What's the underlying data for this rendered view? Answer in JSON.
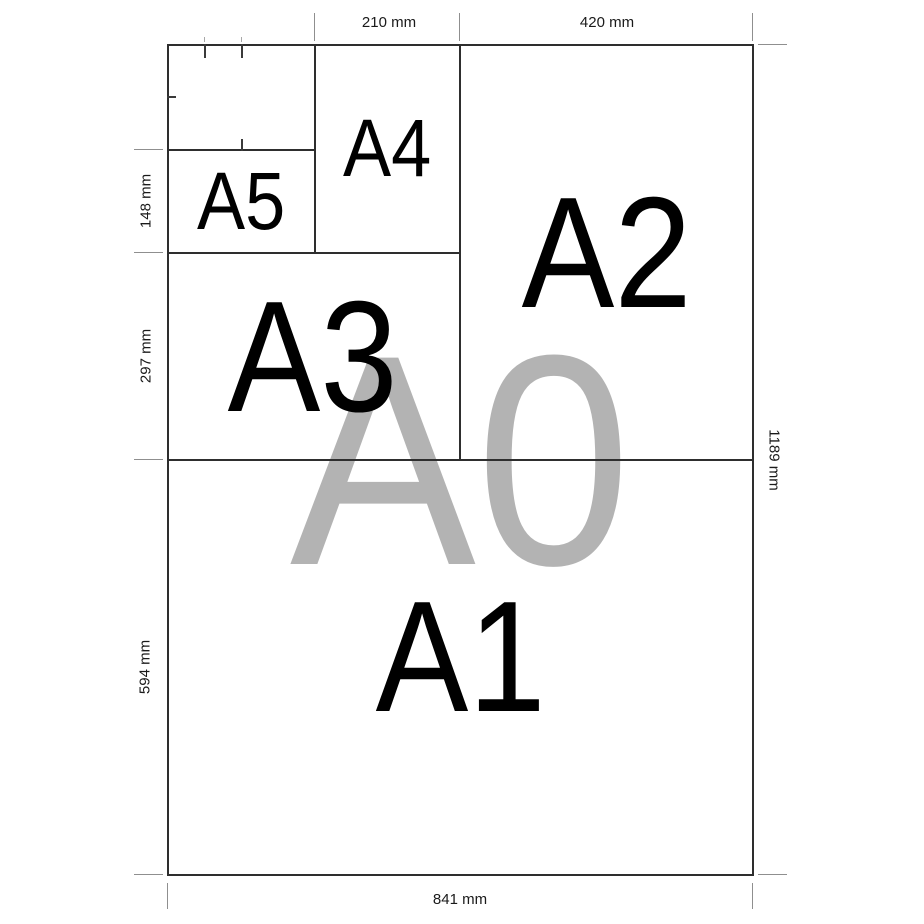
{
  "watermark": {
    "label": "A0",
    "color": "#b3b3b3"
  },
  "panels": [
    {
      "id": "a5",
      "label": "A5"
    },
    {
      "id": "a4",
      "label": "A4"
    },
    {
      "id": "a3",
      "label": "A3"
    },
    {
      "id": "a2",
      "label": "A2"
    },
    {
      "id": "a1",
      "label": "A1"
    }
  ],
  "dimensions": {
    "top": [
      {
        "label": "210 mm"
      },
      {
        "label": "420 mm"
      }
    ],
    "left": [
      {
        "label": "148 mm"
      },
      {
        "label": "297 mm"
      },
      {
        "label": "594 mm"
      }
    ],
    "right": [
      {
        "label": "1189 mm"
      }
    ],
    "bottom": [
      {
        "label": "841 mm"
      }
    ]
  },
  "colors": {
    "line": "#2e2e2e",
    "extension_tick": "#8f8f8f",
    "label_text": "#000000",
    "watermark_text": "#b3b3b3",
    "dimension_text": "#1a1a1a",
    "background": "#ffffff"
  }
}
